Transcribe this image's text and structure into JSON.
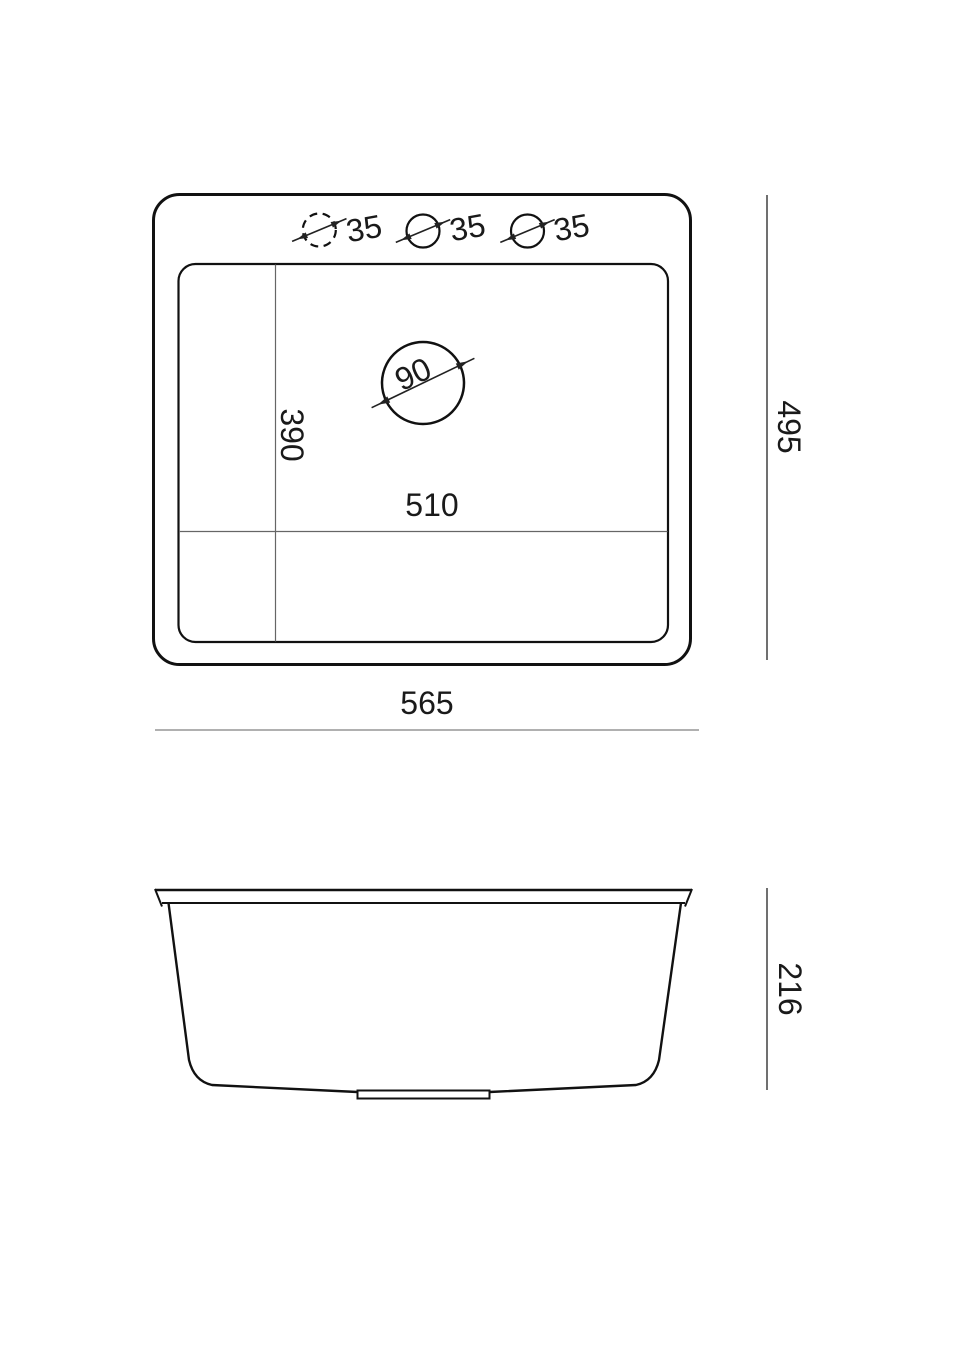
{
  "drawing": {
    "top_view": {
      "faucet_holes": {
        "labels": [
          "35",
          "35",
          "35"
        ]
      },
      "drain": {
        "label": "90"
      },
      "bowl_width_label": "510",
      "bowl_depth_label": "390",
      "overall_width_label": "565",
      "overall_depth_label": "495"
    },
    "side_view": {
      "overall_height_label": "216"
    },
    "dimensions_mm": {
      "faucet_hole_diameter": 35,
      "drain_diameter": 90,
      "bowl_width": 510,
      "bowl_depth": 390,
      "overall_width": 565,
      "overall_depth": 495,
      "overall_height": 216
    },
    "colors": {
      "outline": "#111111",
      "grid_line": "#666666",
      "dimension_line": "#333333",
      "baseline": "#808080",
      "background": "#ffffff"
    }
  }
}
